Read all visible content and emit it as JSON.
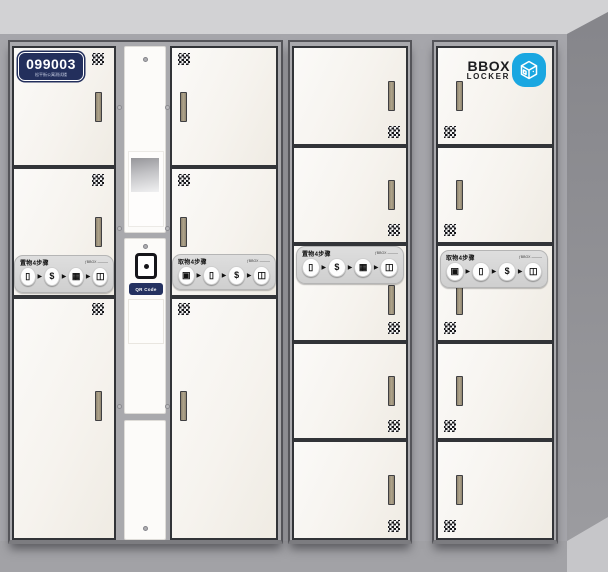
{
  "badge": {
    "number": "099003",
    "sublabel": "松平街公寓测试楼"
  },
  "logo": {
    "line1": "BBOX",
    "line2": "LOCKER",
    "icon": "cube-3d-icon",
    "color": "#1aa7e1"
  },
  "strips": {
    "deposit_title": "置物4步骤",
    "pickup_title": "取物4步骤",
    "brand": "ƒBBOX ———",
    "arrow": "▶",
    "deposit_steps": [
      {
        "name": "scan-phone-icon",
        "glyph": "▯"
      },
      {
        "name": "pay-icon",
        "glyph": "$"
      },
      {
        "name": "deposit-parcel-icon",
        "glyph": "▦"
      },
      {
        "name": "close-door-icon",
        "glyph": "◫"
      }
    ],
    "pickup_steps": [
      {
        "name": "qr-code-icon",
        "glyph": "▣"
      },
      {
        "name": "scan-phone-icon",
        "glyph": "▯"
      },
      {
        "name": "pay-icon",
        "glyph": "$"
      },
      {
        "name": "open-door-icon",
        "glyph": "◫"
      }
    ]
  },
  "console": {
    "qr_label": "QR Code"
  },
  "structure": {
    "cabinets": [
      {
        "name": "left-cabinet",
        "columns": [
          {
            "type": "doors",
            "count": 3,
            "handle_side": "right",
            "qr_corner": "top-right",
            "has_badge": true,
            "strip": "deposit"
          },
          {
            "type": "console",
            "parts": [
              "screen",
              "qr-scanner",
              "qr-code-label",
              "card-reader-area"
            ]
          },
          {
            "type": "doors",
            "count": 3,
            "handle_side": "left",
            "qr_corner": "top-left",
            "strip": "pickup"
          }
        ]
      },
      {
        "name": "middle-cabinet",
        "columns": [
          {
            "type": "doors",
            "count": 5,
            "handle_side": "right",
            "qr_corner": "bottom-right",
            "strip": "deposit"
          }
        ]
      },
      {
        "name": "right-cabinet",
        "columns": [
          {
            "type": "doors",
            "count": 5,
            "handle_side": "left",
            "qr_corner": "bottom-left",
            "has_logo": true,
            "strip": "pickup"
          }
        ]
      }
    ]
  },
  "colors": {
    "badge_navy": "#232f5c",
    "logo_blue": "#1aa7e1",
    "door_offwhite": "#f6f3ee",
    "wall_gray": "#a6a6ab",
    "ceiling_gray": "#cdced0",
    "right_wall_gray": "#8d8d92",
    "floor_gray": "#a2a2a6",
    "strip_gray": "#d7d7d7",
    "handle_tan": "#a2977f",
    "qr_label_navy": "#243160"
  }
}
